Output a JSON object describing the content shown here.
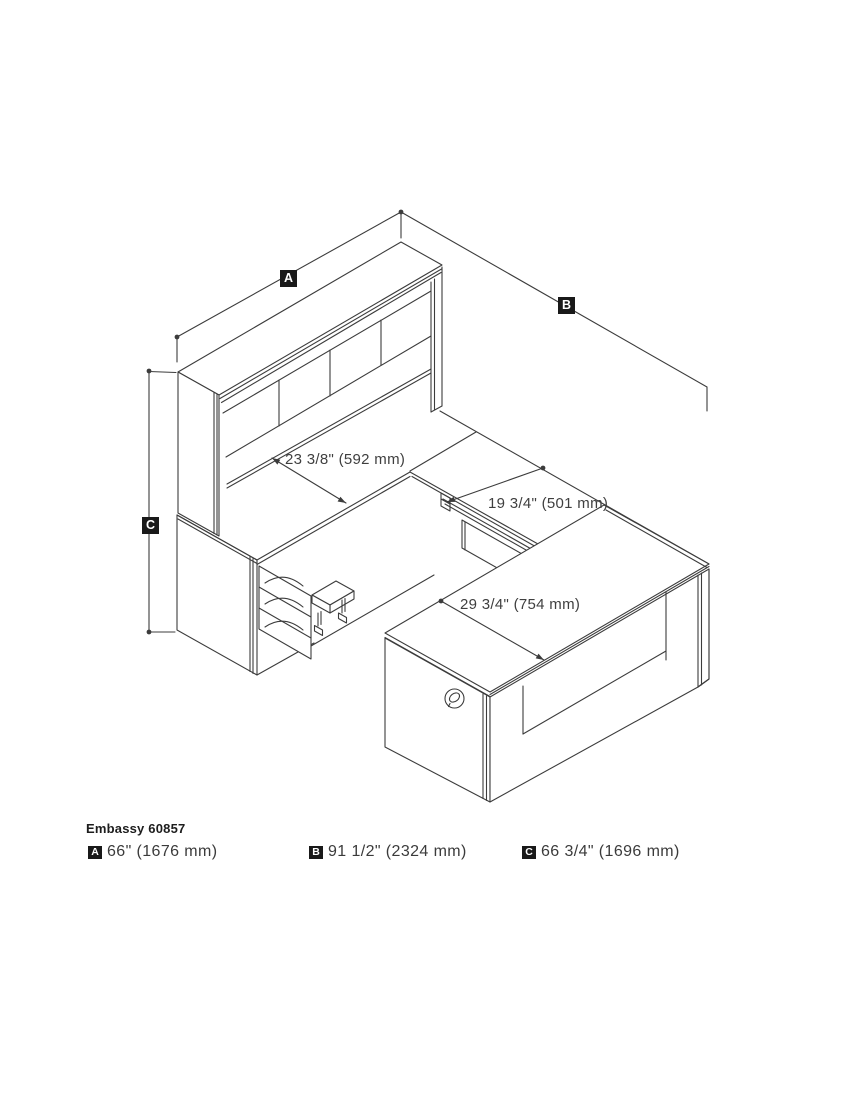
{
  "page": {
    "background": "#ffffff",
    "line_color": "#3c3c3c",
    "badge_color": "#191919"
  },
  "drawing": {
    "callouts": {
      "a": "A",
      "b": "B",
      "c": "C"
    },
    "dimensions": {
      "credenza_depth": "23 3/8\" (592 mm)",
      "return_width": "19 3/4\" (501 mm)",
      "desk_depth": "29 3/4\" (754 mm)"
    }
  },
  "legend": {
    "title": "Embassy 60857",
    "items": [
      {
        "key": "A",
        "value": "66\" (1676 mm)"
      },
      {
        "key": "B",
        "value": "91 1/2\" (2324 mm)"
      },
      {
        "key": "C",
        "value": "66 3/4\" (1696 mm)"
      }
    ]
  }
}
